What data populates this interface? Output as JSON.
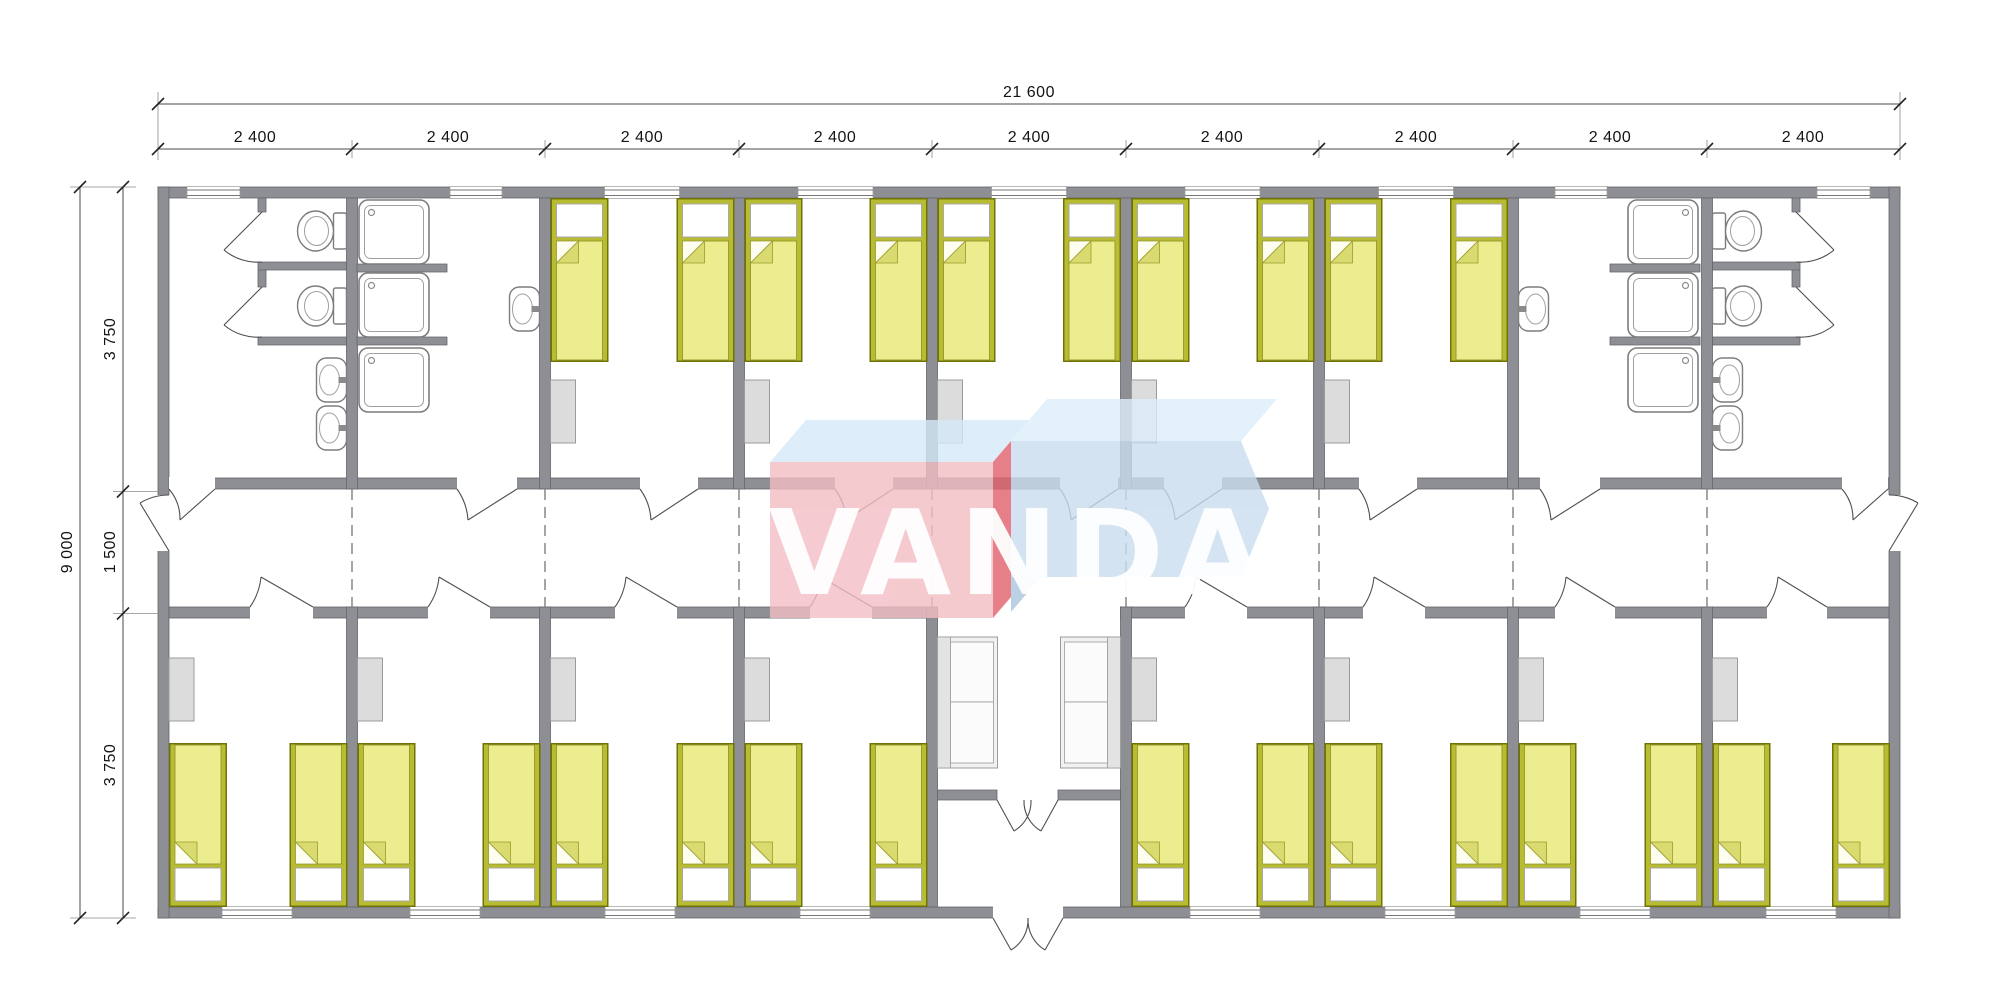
{
  "watermark": {
    "text": "VANDA"
  },
  "dimensions": {
    "total_width": "21 600",
    "module_labels": [
      "2 400",
      "2 400",
      "2 400",
      "2 400",
      "2 400",
      "2 400",
      "2 400",
      "2 400",
      "2 400"
    ],
    "total_height": "9 000",
    "left_segments": [
      "3 750",
      "1 500",
      "3 750"
    ]
  },
  "inventory": {
    "modules": 9,
    "single_beds": 26,
    "bedrooms": 13,
    "toilets": 4,
    "shower_trays": 6,
    "washbasins": 6,
    "sofas": 2,
    "wardrobes": 13,
    "central_corridor": 1,
    "entrance_lobby": 1,
    "sanitary_rooms": 4
  },
  "colors": {
    "bed_mattress": "#ebed8e",
    "bed_frame": "#b8bc33",
    "wall": "#8d8f94",
    "furniture": "#dcdcdc",
    "logo_pink": "#f3bdc4",
    "logo_red": "#e2606b",
    "logo_blue": "#c9ddef",
    "logo_light_blue": "#d5eaf9"
  }
}
